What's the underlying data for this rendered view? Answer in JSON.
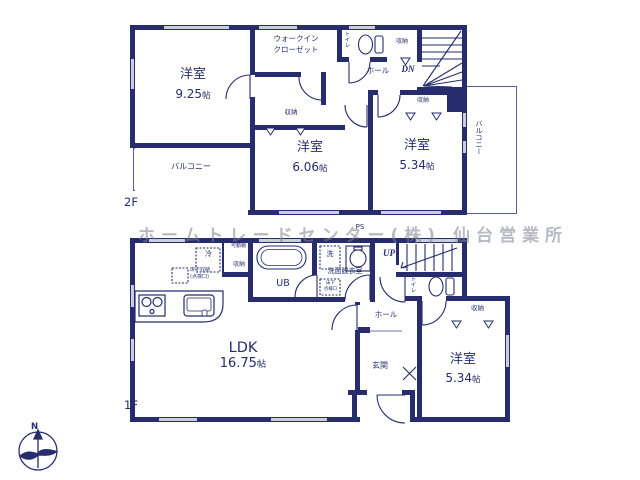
{
  "units": {
    "jo": "帖"
  },
  "watermark": "ホームトレードセンター(株) 仙台営業所",
  "compass_n": "N",
  "colors": {
    "wall": "#262c6d",
    "room_floor": "#f9efcf",
    "closet": "#f8dce0",
    "bath_floor": "#e2e8f6",
    "window": "#c9cddf"
  },
  "f2": {
    "floor_label": "2F",
    "room_925_name": "洋室",
    "room_925_num": "9.25",
    "wic_line1": "ウォークイン",
    "wic_line2": "クローゼット",
    "toilet": "トイレ",
    "hall": "ホール",
    "dn": "DN",
    "storage_top": "収納",
    "storage_mid": "収納",
    "storage_right": "収納",
    "room_606_name": "洋室",
    "room_606_num": "6.06",
    "room_534_name": "洋室",
    "room_534_num": "5.34",
    "balcony_left": "バルコニー",
    "balcony_right": "バルコニー"
  },
  "f1": {
    "floor_label": "1F",
    "ps": "PS",
    "up": "UP",
    "ldk_name": "LDK",
    "ldk_num": "16.75",
    "hall": "ホール",
    "genkan": "玄関",
    "toilet": "トイレ",
    "ub": "UB",
    "wash": "洗",
    "senmen": "洗面脱衣室",
    "yukashita_label1": "床下収納",
    "yukashita_label2": "(点検口)",
    "yukashita2_line1": "床下",
    "yukashita2_line2": "点検口",
    "rei": "冷",
    "kadodana": "可動棚",
    "storage_kitchen": "収納",
    "room_534_name": "洋室",
    "room_534_num": "5.34",
    "storage_room": "収納"
  }
}
